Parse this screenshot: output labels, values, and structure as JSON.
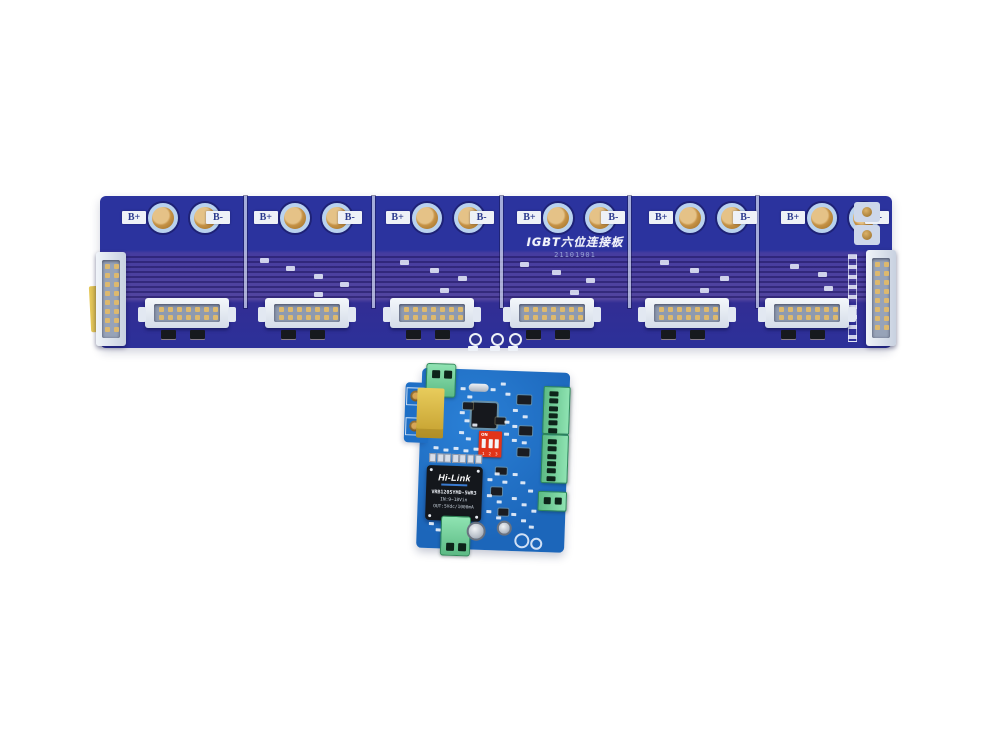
{
  "background_color": "#ffffff",
  "top_board": {
    "title": "IGBT六位连接板",
    "serial": "21101901",
    "terminal_positive_label": "B+",
    "terminal_negative_label": "B-",
    "section_count": 6,
    "idc_connector_count": 6,
    "colors": {
      "board_blue": "#2b339e",
      "trace_band_purple": "#52459f",
      "pad_gold": "#c59246",
      "pad_ring": "#b9d2ee",
      "label_background": "#eef1f7",
      "label_text": "#2b3a8e",
      "connector_white": "#e4eaf2",
      "kapton_tape_yellow": "#d9b845"
    }
  },
  "bottom_board": {
    "power_module": {
      "brand": "Hi-Link",
      "model": "VRB1205YMD-5WR3",
      "input_rating": "IN:9~18Vin",
      "output_rating": "OUT:5Vdc/1000mA",
      "body_color": "#14171c"
    },
    "dip_switch": {
      "on_label": "ON",
      "positions": [
        "1",
        "2",
        "3"
      ],
      "body_color": "#e23419"
    },
    "colors": {
      "board_blue": "#1e6fc6",
      "terminal_green": "#7fd9a4",
      "transformer_yellow": "#d9b845"
    }
  }
}
